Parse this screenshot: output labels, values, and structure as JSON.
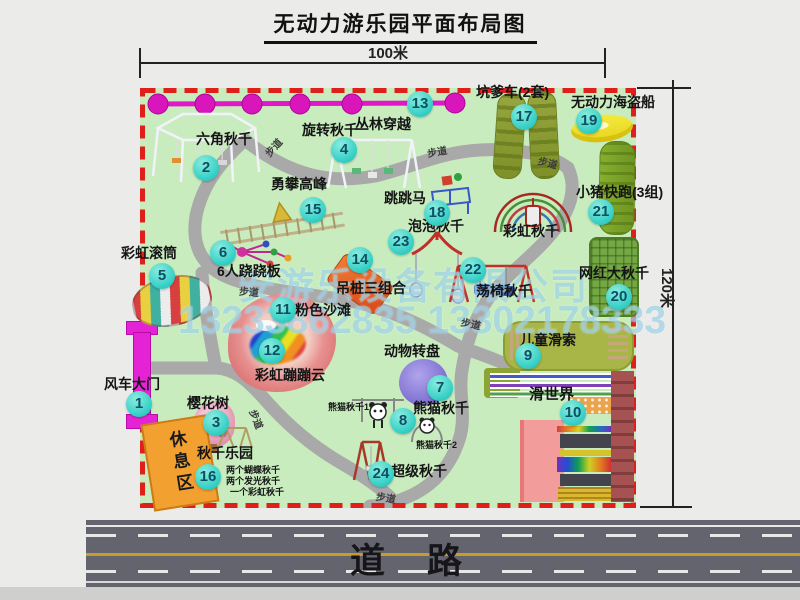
{
  "title": "无动力游乐园平面布局图",
  "dimensions": {
    "width_label": "100米",
    "height_label": "120米"
  },
  "road": {
    "label": "道路"
  },
  "watermark": {
    "line1": "安游乐设备有限公司",
    "line2": "13233862835 13302178333"
  },
  "rest_area": {
    "label": "休息区"
  },
  "unnumbered": {
    "rainbow_swing": "彩虹秋千"
  },
  "path_labels": [
    "步道",
    "步道",
    "步道",
    "步道",
    "步道",
    "步道",
    "步道"
  ],
  "items": [
    {
      "num": "1",
      "label": "风车大门"
    },
    {
      "num": "2",
      "label": "六角秋千"
    },
    {
      "num": "3",
      "label": "樱花树"
    },
    {
      "num": "4",
      "label": "旋转秋千"
    },
    {
      "num": "5",
      "label": "彩虹滚筒"
    },
    {
      "num": "6",
      "label": "6人跷跷板"
    },
    {
      "num": "7",
      "label": "动物转盘"
    },
    {
      "num": "8",
      "label": "熊猫秋千",
      "sub1": "熊猫秋千1",
      "sub2": "熊猫秋千2"
    },
    {
      "num": "9",
      "label": "儿童滑索"
    },
    {
      "num": "10",
      "label": "滑世界"
    },
    {
      "num": "11",
      "label": "粉色沙滩"
    },
    {
      "num": "12",
      "label": "彩虹蹦蹦云"
    },
    {
      "num": "13",
      "label": "丛林穿越"
    },
    {
      "num": "14",
      "label": "吊桩三组合"
    },
    {
      "num": "15",
      "label": "勇攀高峰"
    },
    {
      "num": "16",
      "label": "秋千乐园",
      "notes": [
        "两个蝴蝶秋千",
        "两个发光秋千",
        "一个彩虹秋千"
      ]
    },
    {
      "num": "17",
      "label": "坑爹车(2套)"
    },
    {
      "num": "18",
      "label": "跳跳马"
    },
    {
      "num": "19",
      "label": "无动力海盗船"
    },
    {
      "num": "20",
      "label": "网红大秋千"
    },
    {
      "num": "21",
      "label": "小猪快跑(3组)"
    },
    {
      "num": "22",
      "label": "荡椅秋千"
    },
    {
      "num": "23",
      "label": "泡泡秋千"
    },
    {
      "num": "24",
      "label": "超级秋千"
    }
  ]
}
